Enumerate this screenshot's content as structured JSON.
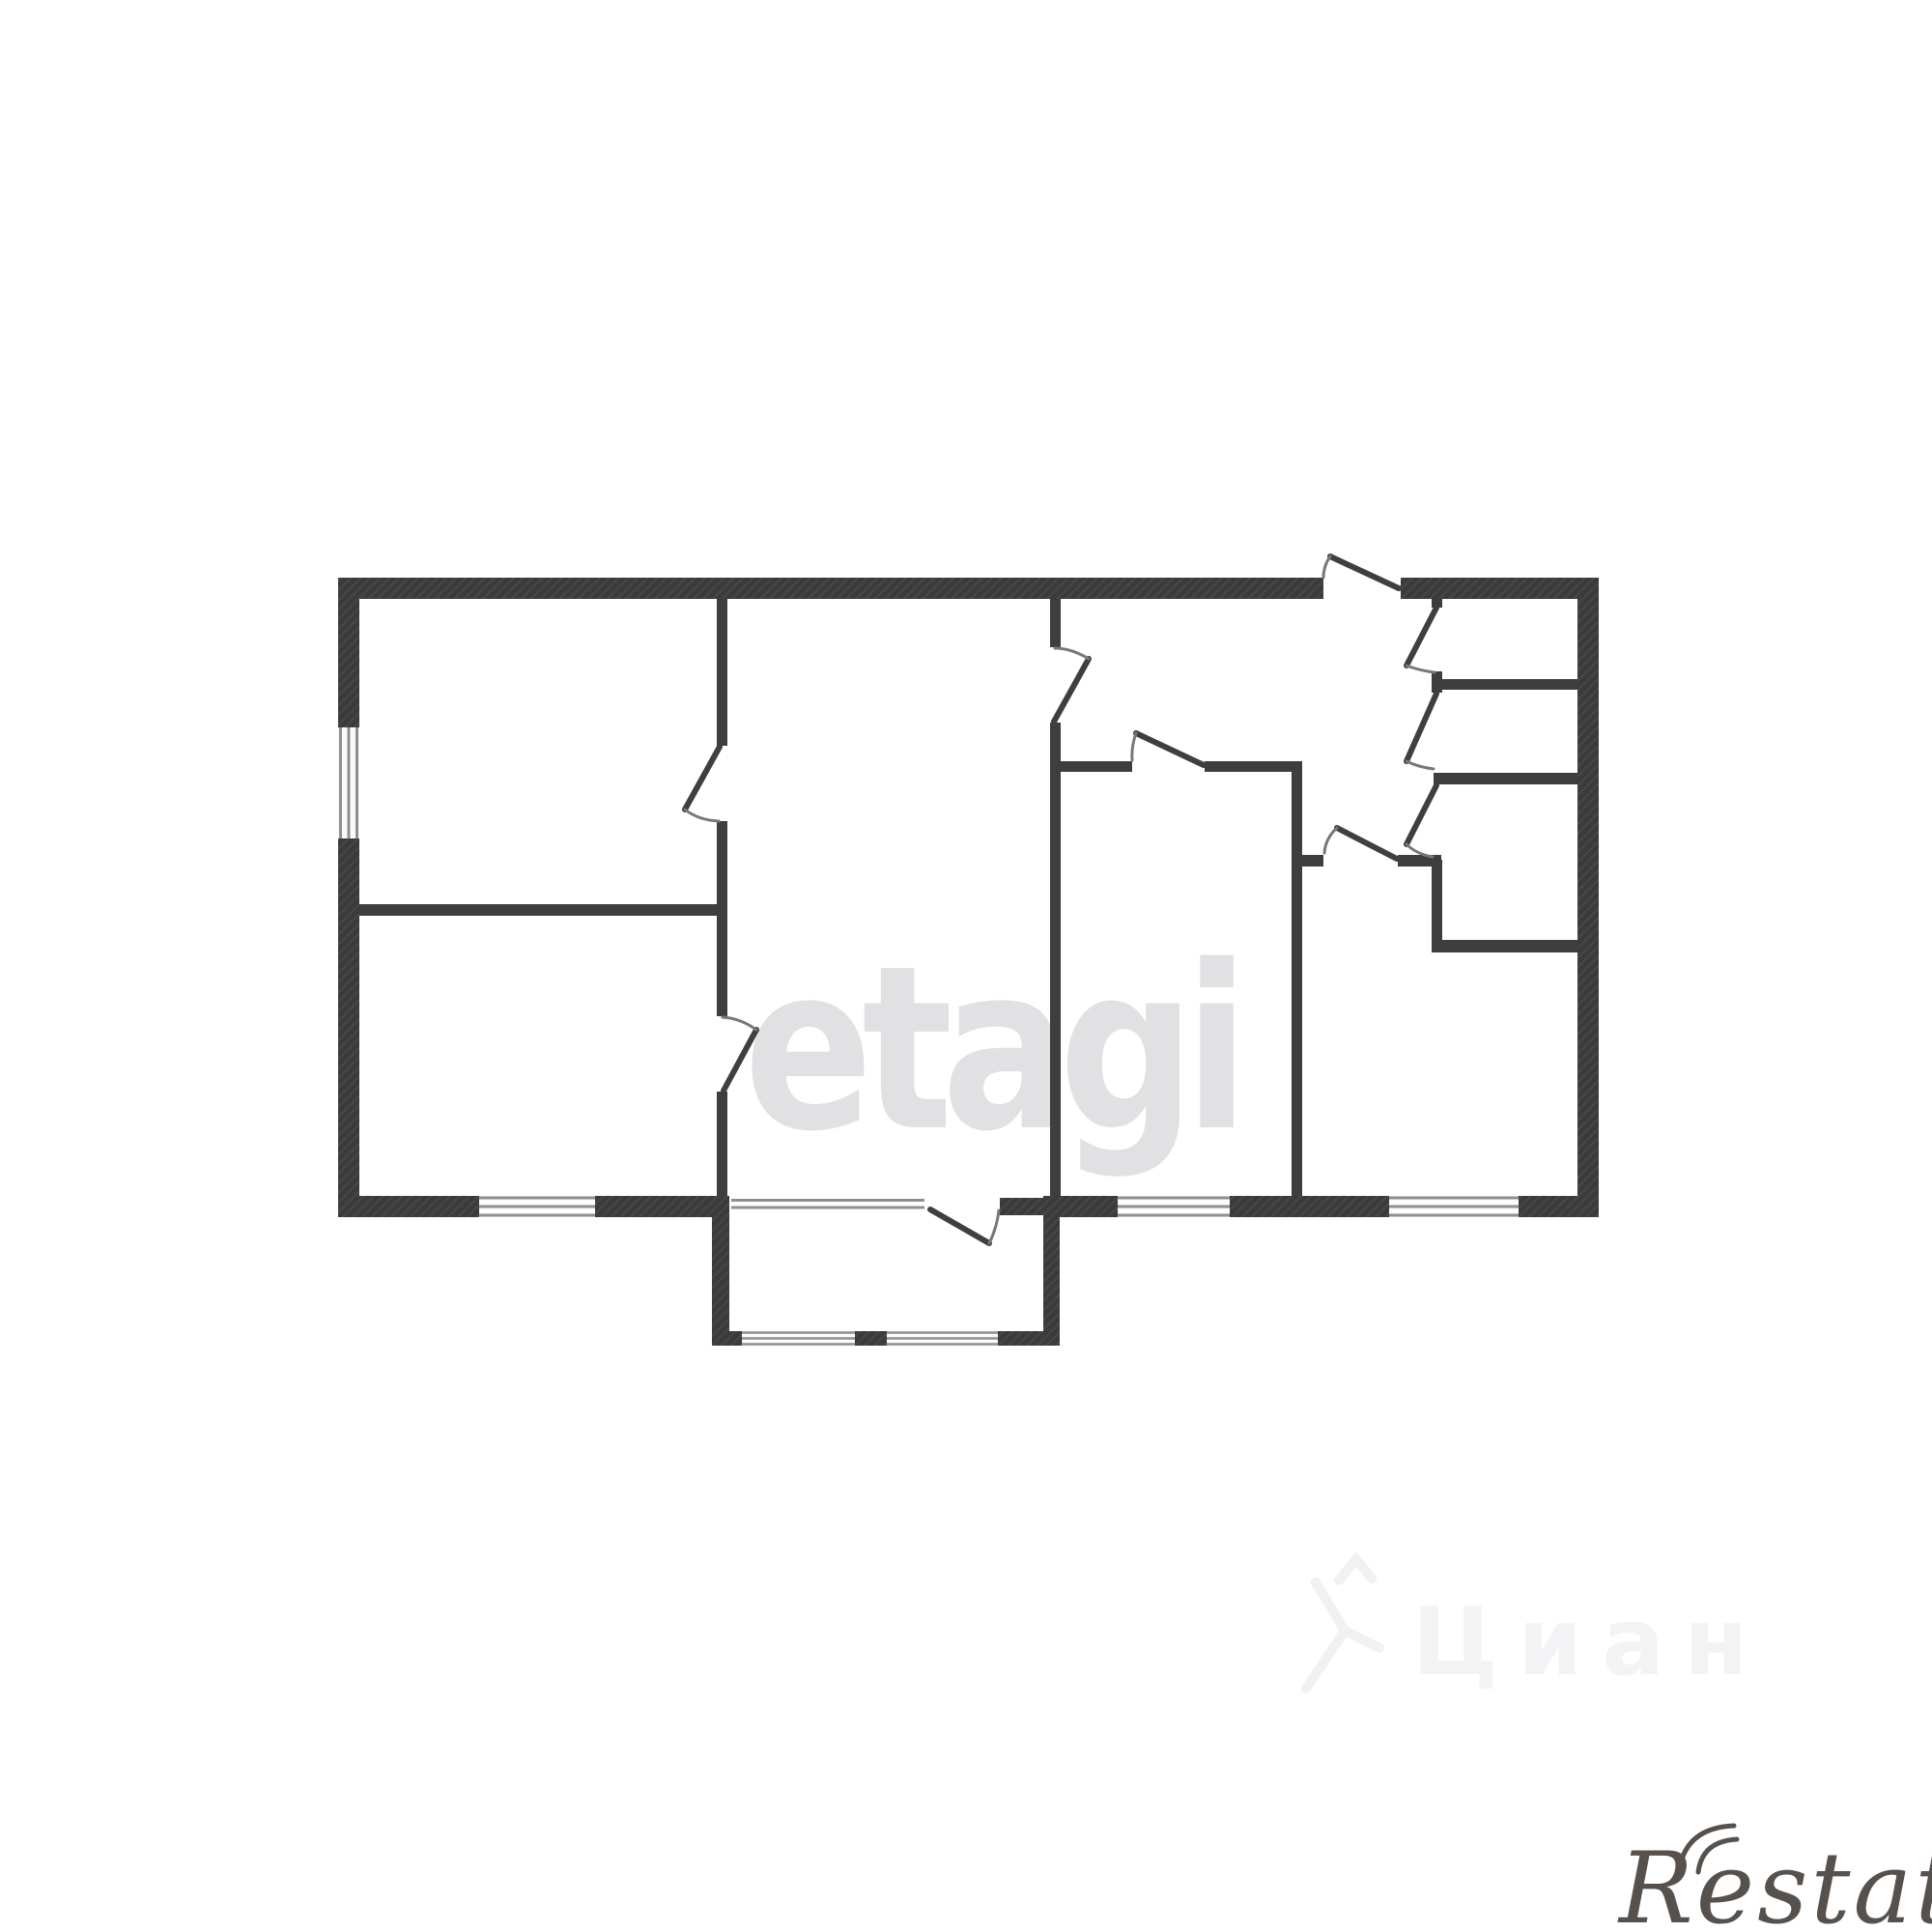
{
  "image": {
    "background_color": "#ffffff"
  },
  "floor_plan": {
    "wall_color": "#3b3b3b",
    "thin_wall_color": "#3e3e3e",
    "door_leaf_color": "#3f3f3f",
    "door_arc_color": "#787878",
    "window_line_color": "#8f8f8f",
    "window_fill_color": "#fbfbfb"
  },
  "watermarks": {
    "etagi": {
      "text": "etagi",
      "color": "#e1e0e3"
    },
    "cian": {
      "text": "Циан",
      "color": "#f3f2f4"
    },
    "restate": {
      "text": "Restate",
      "color": "#57514d"
    }
  }
}
